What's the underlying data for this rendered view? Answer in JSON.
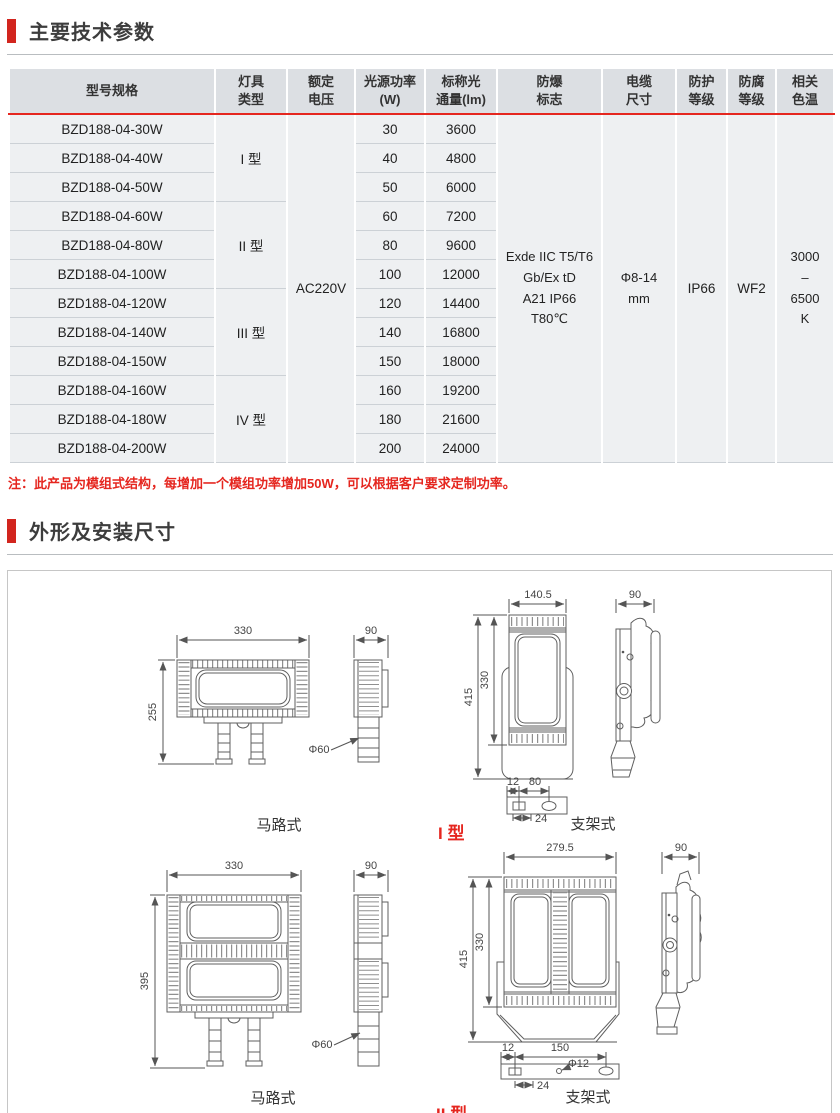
{
  "colors": {
    "accent_red": "#d2251e",
    "note_red": "#e5261f",
    "table_header_bg": "#dcdfe3",
    "table_row_bg": "#eef0f2"
  },
  "sections": {
    "tech": {
      "title": "主要技术参数",
      "note": "注：此产品为模组式结构，每增加一个模组功率增加50W，可以根据客户要求定制功率。"
    },
    "dims": {
      "title": "外形及安装尺寸"
    }
  },
  "table": {
    "headers": [
      {
        "key": "model",
        "label": "型号规格"
      },
      {
        "key": "type",
        "label": "灯具\n类型"
      },
      {
        "key": "voltage",
        "label": "额定\n电压"
      },
      {
        "key": "power",
        "label": "光源功率\n(W)"
      },
      {
        "key": "flux",
        "label": "标称光\n通量(lm)"
      },
      {
        "key": "ex_mark",
        "label": "防爆\n标志"
      },
      {
        "key": "cable",
        "label": "电缆\n尺寸"
      },
      {
        "key": "ip",
        "label": "防护\n等级"
      },
      {
        "key": "corrosion",
        "label": "防腐\n等级"
      },
      {
        "key": "cct",
        "label": "相关\n色温"
      }
    ],
    "type_groups": [
      {
        "label": "I 型"
      },
      {
        "label": "II 型"
      },
      {
        "label": "III 型"
      },
      {
        "label": "IV 型"
      }
    ],
    "merged": {
      "voltage": "AC220V",
      "ex_mark": "Exde IIC T5/T6\nGb/Ex tD\nA21 IP66\nT80℃",
      "cable": "Φ8-14\nmm",
      "ip": "IP66",
      "corrosion": "WF2",
      "cct": "3000\n–\n6500\nK"
    },
    "rows": [
      {
        "model": "BZD188-04-30W",
        "power": "30",
        "flux": "3600"
      },
      {
        "model": "BZD188-04-40W",
        "power": "40",
        "flux": "4800"
      },
      {
        "model": "BZD188-04-50W",
        "power": "50",
        "flux": "6000"
      },
      {
        "model": "BZD188-04-60W",
        "power": "60",
        "flux": "7200"
      },
      {
        "model": "BZD188-04-80W",
        "power": "80",
        "flux": "9600"
      },
      {
        "model": "BZD188-04-100W",
        "power": "100",
        "flux": "12000"
      },
      {
        "model": "BZD188-04-120W",
        "power": "120",
        "flux": "14400"
      },
      {
        "model": "BZD188-04-140W",
        "power": "140",
        "flux": "16800"
      },
      {
        "model": "BZD188-04-150W",
        "power": "150",
        "flux": "18000"
      },
      {
        "model": "BZD188-04-160W",
        "power": "160",
        "flux": "19200"
      },
      {
        "model": "BZD188-04-180W",
        "power": "180",
        "flux": "21600"
      },
      {
        "model": "BZD188-04-200W",
        "power": "200",
        "flux": "24000"
      }
    ]
  },
  "drawings": {
    "type1": {
      "road": {
        "width": "330",
        "height": "255",
        "side_width": "90",
        "pole_dia": "Φ60",
        "label": "马路式"
      },
      "bracket": {
        "width": "140.5",
        "total_height": "415",
        "body_height": "330",
        "side_width": "90",
        "dim_12": "12",
        "dim_80": "80",
        "dim_24": "24",
        "label": "支架式"
      },
      "type_label": "I 型"
    },
    "type2": {
      "road": {
        "width": "330",
        "height": "395",
        "side_width": "90",
        "pole_dia": "Φ60",
        "label": "马路式"
      },
      "bracket": {
        "width": "279.5",
        "total_height": "415",
        "body_height": "330",
        "side_width": "90",
        "dim_12": "12",
        "dim_150": "150",
        "hole_dia": "Φ12",
        "dim_24": "24",
        "label": "支架式"
      },
      "type_label": "II 型"
    }
  }
}
